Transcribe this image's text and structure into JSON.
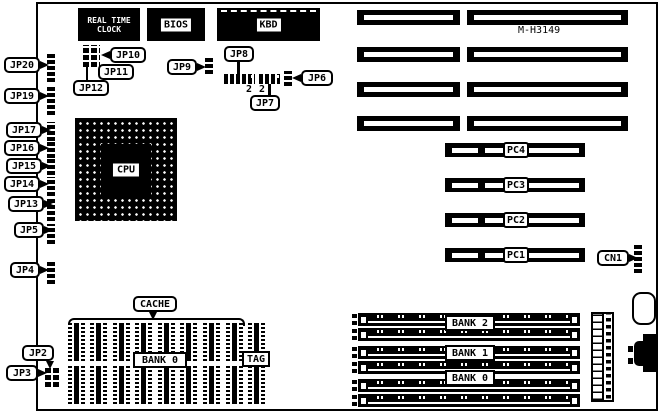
{
  "board": {
    "model": "M-H3149"
  },
  "chips": {
    "rtc": {
      "line1": "REAL TIME",
      "line2": "CLOCK"
    },
    "bios": {
      "label": "BIOS"
    },
    "kbd": {
      "label": "KBD"
    },
    "cpu": {
      "label": "CPU"
    }
  },
  "jumpers": {
    "jp2": "JP2",
    "jp3": "JP3",
    "jp4": "JP4",
    "jp5": "JP5",
    "jp6": "JP6",
    "jp7": "JP7",
    "jp8": "JP8",
    "jp9": "JP9",
    "jp10": "JP10",
    "jp11": "JP11",
    "jp12": "JP12",
    "jp13": "JP13",
    "jp14": "JP14",
    "jp15": "JP15",
    "jp16": "JP16",
    "jp17": "JP17",
    "jp19": "JP19",
    "jp20": "JP20"
  },
  "connectors": {
    "cn1": "CN1"
  },
  "pci_slots": {
    "pc1": "PC1",
    "pc2": "PC2",
    "pc3": "PC3",
    "pc4": "PC4"
  },
  "cache": {
    "title": "CACHE",
    "bank0": "BANK 0",
    "tag": "TAG"
  },
  "memory_banks": {
    "bank2": "BANK 2",
    "bank1": "BANK 1",
    "bank0": "BANK 0"
  },
  "pin_numbers": {
    "jp8": "2",
    "jp7": "2"
  }
}
